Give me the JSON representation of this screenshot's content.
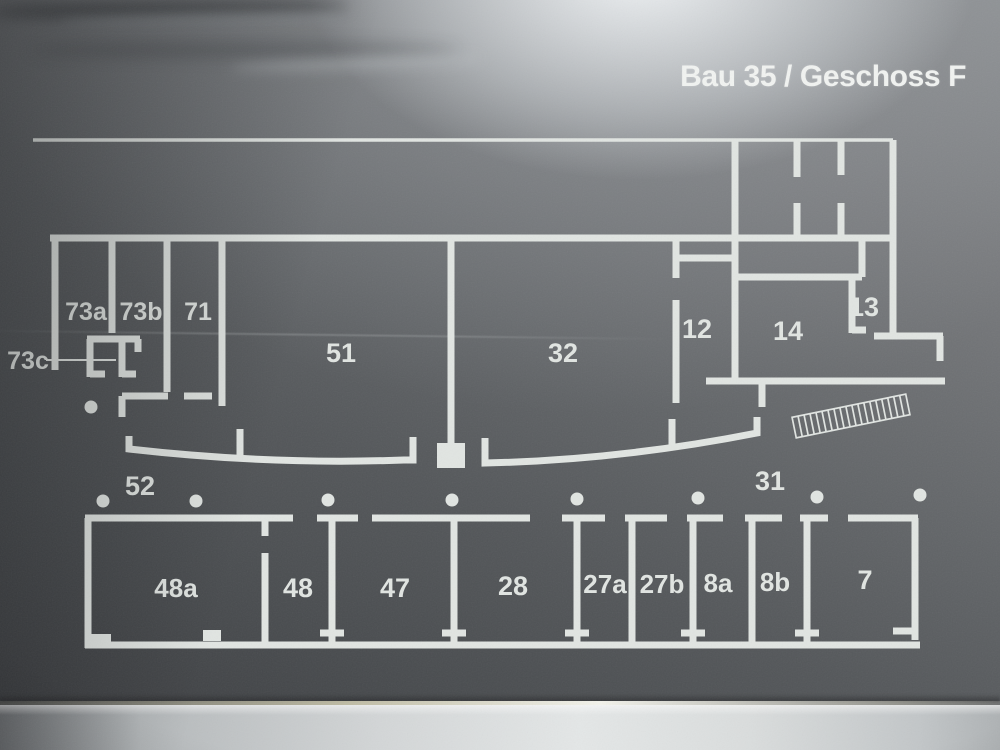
{
  "sign": {
    "title": "Bau 35 / Geschoss F"
  },
  "colors": {
    "ink": "#e1e5e2",
    "title_text": "#f1f3f1"
  },
  "floorplan": {
    "stroke_wall": 7,
    "stroke_thin": 3.5,
    "stroke_leader": 2,
    "thin_lines": [
      [
        33,
        140,
        893,
        140
      ]
    ],
    "walls": [
      [
        50,
        238,
        893,
        238
      ],
      [
        893,
        140,
        893,
        338
      ],
      [
        735,
        140,
        735,
        381
      ],
      [
        797,
        140,
        797,
        177
      ],
      [
        797,
        203,
        797,
        238
      ],
      [
        841,
        140,
        841,
        175
      ],
      [
        841,
        203,
        841,
        238
      ],
      [
        862,
        238,
        862,
        277
      ],
      [
        735,
        277,
        862,
        277
      ],
      [
        852,
        277,
        852,
        333
      ],
      [
        852,
        330,
        866,
        330
      ],
      [
        874,
        336,
        943,
        336
      ],
      [
        940,
        336,
        940,
        361
      ],
      [
        676,
        258,
        735,
        258
      ],
      [
        676,
        238,
        676,
        278
      ],
      [
        676,
        300,
        676,
        403
      ],
      [
        672,
        419,
        672,
        449
      ],
      [
        706,
        381,
        945,
        381
      ],
      [
        762,
        381,
        762,
        407
      ],
      [
        55,
        238,
        55,
        370
      ],
      [
        112,
        238,
        112,
        333
      ],
      [
        167,
        238,
        167,
        392
      ],
      [
        222,
        238,
        222,
        406
      ],
      [
        122,
        396,
        168,
        396
      ],
      [
        184,
        396,
        212,
        396
      ],
      [
        122,
        396,
        122,
        417
      ],
      [
        87,
        339,
        140,
        339
      ],
      [
        90,
        339,
        90,
        377
      ],
      [
        90,
        374,
        105,
        374
      ],
      [
        122,
        342,
        122,
        377
      ],
      [
        122,
        374,
        136,
        374
      ],
      [
        138,
        339,
        138,
        352
      ],
      [
        451,
        238,
        451,
        444
      ],
      [
        240,
        429,
        240,
        461
      ],
      [
        85,
        518,
        293,
        518
      ],
      [
        317,
        518,
        358,
        518
      ],
      [
        372,
        518,
        530,
        518
      ],
      [
        562,
        518,
        605,
        518
      ],
      [
        625,
        518,
        667,
        518
      ],
      [
        687,
        518,
        723,
        518
      ],
      [
        745,
        518,
        782,
        518
      ],
      [
        800,
        518,
        828,
        518
      ],
      [
        848,
        518,
        918,
        518
      ],
      [
        88,
        518,
        88,
        648
      ],
      [
        915,
        518,
        915,
        640
      ],
      [
        893,
        631,
        915,
        631
      ],
      [
        85,
        645,
        920,
        645
      ],
      [
        265,
        518,
        265,
        536
      ],
      [
        265,
        553,
        265,
        645
      ],
      [
        332,
        518,
        332,
        645
      ],
      [
        454,
        518,
        454,
        645
      ],
      [
        577,
        518,
        577,
        645
      ],
      [
        632,
        518,
        632,
        645
      ],
      [
        693,
        518,
        693,
        645
      ],
      [
        752,
        518,
        752,
        645
      ],
      [
        807,
        518,
        807,
        645
      ],
      [
        320,
        633,
        344,
        633
      ],
      [
        442,
        633,
        466,
        633
      ],
      [
        565,
        633,
        589,
        633
      ],
      [
        681,
        633,
        705,
        633
      ],
      [
        795,
        633,
        819,
        633
      ]
    ],
    "corridor_paths": [
      "M129,436 L129,449 Q270,465 404,460 L413,460 L413,437",
      "M485,438 L485,463 Q620,460 757,433 L757,417"
    ],
    "filled_rects": [
      {
        "name": "center-pillar-marker",
        "x": 437,
        "y": 443,
        "w": 28,
        "h": 25
      },
      {
        "name": "door-marker-48a",
        "x": 203,
        "y": 630,
        "w": 18,
        "h": 11
      },
      {
        "name": "corner-block",
        "x": 85,
        "y": 634,
        "w": 26,
        "h": 13
      }
    ],
    "dots": {
      "r": 6.5,
      "points": [
        [
          91,
          407
        ],
        [
          103,
          501
        ],
        [
          196,
          501
        ],
        [
          328,
          500
        ],
        [
          452,
          500
        ],
        [
          577,
          499
        ],
        [
          698,
          498
        ],
        [
          817,
          497
        ],
        [
          920,
          495
        ]
      ]
    },
    "ramp": {
      "cx": 851,
      "cy": 416,
      "half_len": 58,
      "half_h": 10.5,
      "angle": -11.5,
      "hatch_step": 6.1,
      "line_w": 1.7
    },
    "leader": [
      46,
      360,
      116,
      360
    ],
    "labels": [
      {
        "t": "73c",
        "x": 28,
        "y": 361,
        "fs": 25
      },
      {
        "t": "73a",
        "x": 86,
        "y": 312,
        "fs": 25
      },
      {
        "t": "73b",
        "x": 141,
        "y": 312,
        "fs": 25
      },
      {
        "t": "71",
        "x": 198,
        "y": 312,
        "fs": 25
      },
      {
        "t": "51",
        "x": 341,
        "y": 353,
        "fs": 27
      },
      {
        "t": "32",
        "x": 563,
        "y": 353,
        "fs": 27
      },
      {
        "t": "12",
        "x": 697,
        "y": 329,
        "fs": 27
      },
      {
        "t": "14",
        "x": 788,
        "y": 331,
        "fs": 27
      },
      {
        "t": "13",
        "x": 864,
        "y": 307,
        "fs": 27
      },
      {
        "t": "52",
        "x": 140,
        "y": 486,
        "fs": 27
      },
      {
        "t": "31",
        "x": 770,
        "y": 481,
        "fs": 27
      },
      {
        "t": "48a",
        "x": 176,
        "y": 588,
        "fs": 26
      },
      {
        "t": "48",
        "x": 298,
        "y": 588,
        "fs": 27
      },
      {
        "t": "47",
        "x": 395,
        "y": 588,
        "fs": 27
      },
      {
        "t": "28",
        "x": 513,
        "y": 586,
        "fs": 27
      },
      {
        "t": "27a",
        "x": 605,
        "y": 584,
        "fs": 26
      },
      {
        "t": "27b",
        "x": 662,
        "y": 584,
        "fs": 26
      },
      {
        "t": "8a",
        "x": 718,
        "y": 583,
        "fs": 26
      },
      {
        "t": "8b",
        "x": 775,
        "y": 582,
        "fs": 26
      },
      {
        "t": "7",
        "x": 865,
        "y": 580,
        "fs": 27
      }
    ]
  }
}
